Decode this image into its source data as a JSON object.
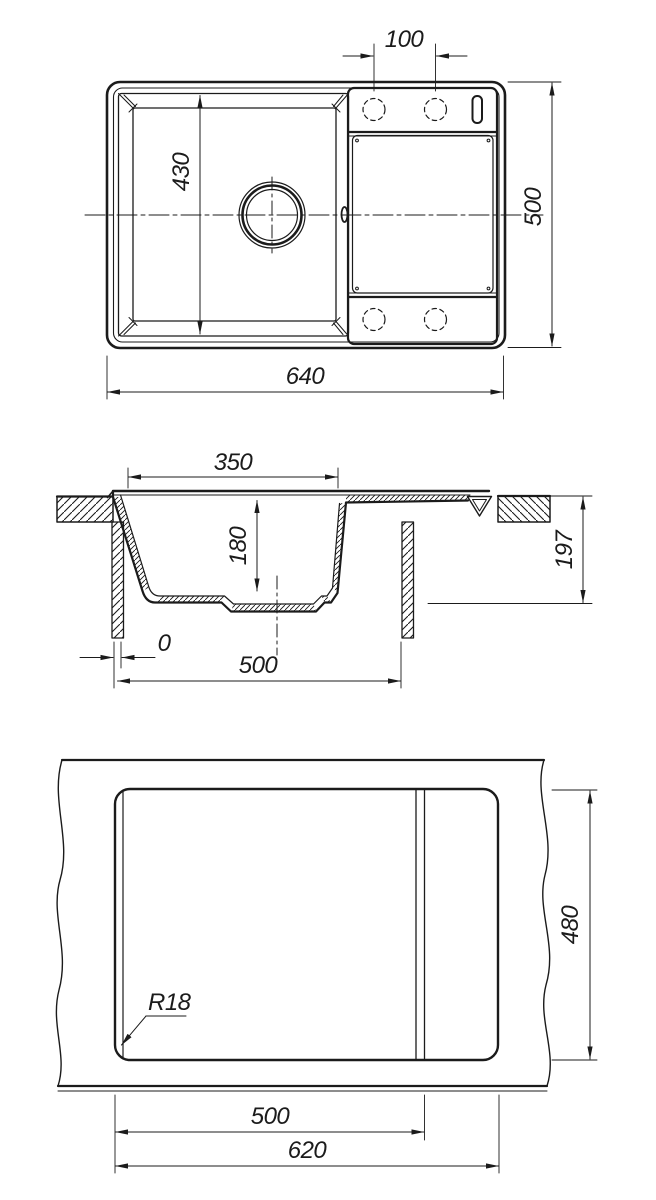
{
  "drawing": {
    "background": "#ffffff",
    "line_color": "#1b1b1b",
    "views": {
      "top_view": {
        "name": "sink top view",
        "dimensions": {
          "tap_hole_spacing": "100",
          "bowl_width": "430",
          "overall_depth": "500",
          "overall_length": "640"
        }
      },
      "section_view": {
        "name": "sink cross section",
        "dimensions": {
          "bowl_opening_width": "350",
          "bowl_depth": "180",
          "overall_height": "197",
          "edge_offset": "0",
          "cabinet_width": "500"
        }
      },
      "cutout_view": {
        "name": "countertop cutout template",
        "dimensions": {
          "cutout_height": "480",
          "corner_radius": "R18",
          "cutout_width_main": "500",
          "cutout_width_total": "620"
        }
      }
    }
  }
}
